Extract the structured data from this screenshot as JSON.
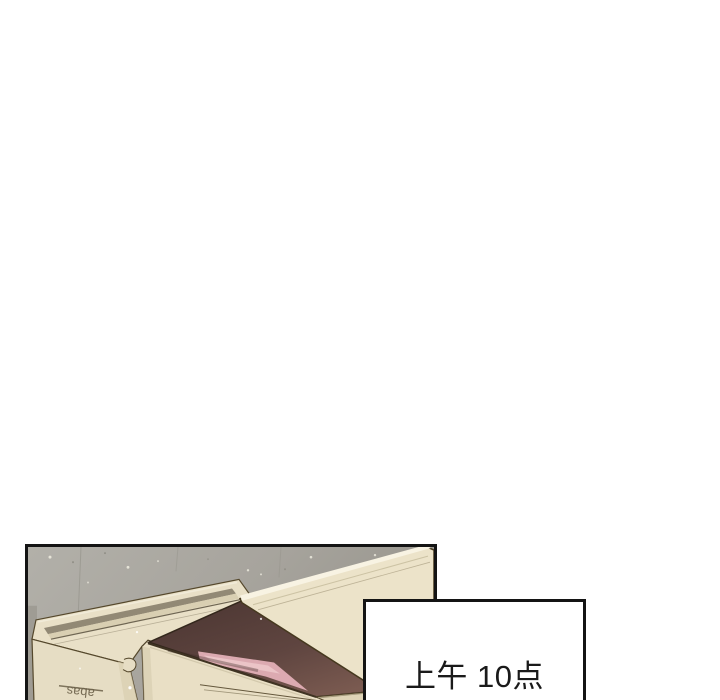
{
  "page": {
    "background": "#ffffff"
  },
  "panel": {
    "description": "comic panel of stacked cardboard boxes against a gray wall, one box open showing a pink item",
    "border_color": "#141414",
    "colors": {
      "wall": "#a9a7a0",
      "wall_dark": "#98958d",
      "box": "#e9e0c7",
      "box_light": "#ece3c9",
      "box_shade": "#d9ceb1",
      "box_bottom": "#ded3b6",
      "tape_dark": "#8d8471",
      "tape_light": "#d9cfb2",
      "flap_highlight": "#f8f3e3",
      "interior_dark": "#523b36",
      "pink_item": "#dcaab1",
      "pink_highlight": "#ecc6ca",
      "outline": "#55482c"
    },
    "box_label": "abas"
  },
  "caption": {
    "text": "上午 10点",
    "background": "#ffffff",
    "border_color": "#141414",
    "text_color": "#1a1a1a"
  }
}
